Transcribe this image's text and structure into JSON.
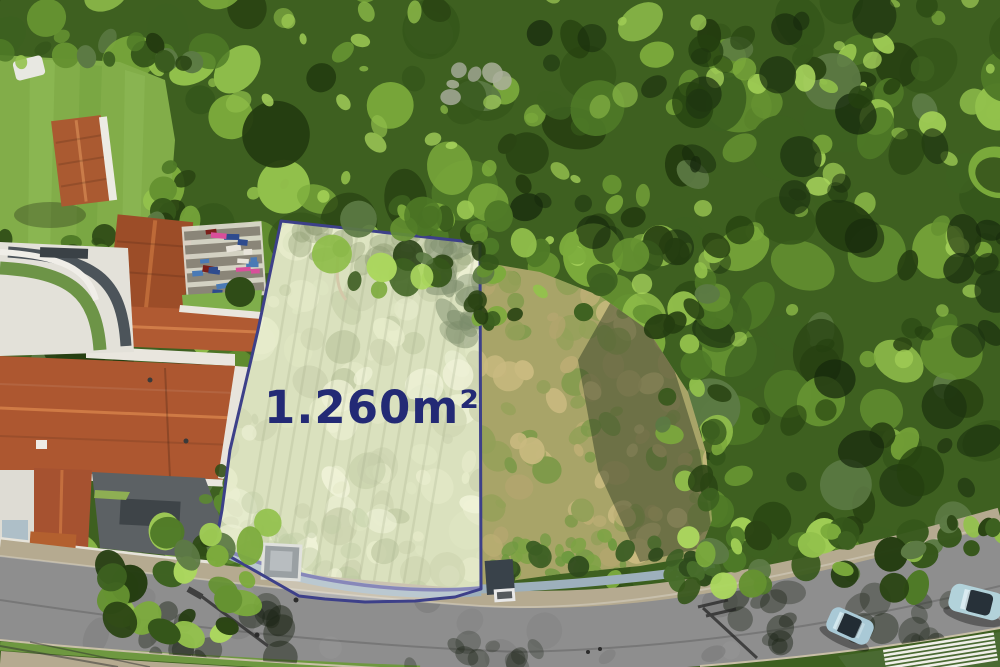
{
  "photo": {
    "type": "aerial-drone-photo",
    "subject": "Top-down aerial photo of a vacant residential land lot highlighted for sale, bordered by tiled-roof houses on the left, dense forest above and right, a scrub field beside it and a curved street along the bottom"
  },
  "lot": {
    "area_label": "1.260m²",
    "label_color": "#232a75",
    "border_color": "#3d4089",
    "highlight_fill": "rgba(255,255,255,0.30)"
  },
  "street": {
    "parked_cars": 2
  },
  "scene": {
    "elements": [
      "forest-canopy",
      "front-lawn",
      "garden-shed",
      "tiled-roof-house",
      "pergola-storage-rack",
      "mansion-roof",
      "curved-terrace",
      "driveway",
      "scrub-field",
      "tree-shadow",
      "boundary-wall",
      "wall-gate",
      "street",
      "sidewalk",
      "street-light-shadow",
      "parked-car",
      "white-slat-roof"
    ]
  },
  "palette": {
    "forest_green": "#3e6020",
    "lot_grass": "#cbd5a2",
    "field_tan": "#a8a468",
    "roof_terracotta": "#ad5730",
    "road_gray": "#8e8e8e",
    "sidewalk_tan": "#b5aa90",
    "wall_blue_gray": "#9db0bc",
    "wall_stripe_navy": "#53549b",
    "car_silver_blue": "#a9c9d6"
  }
}
